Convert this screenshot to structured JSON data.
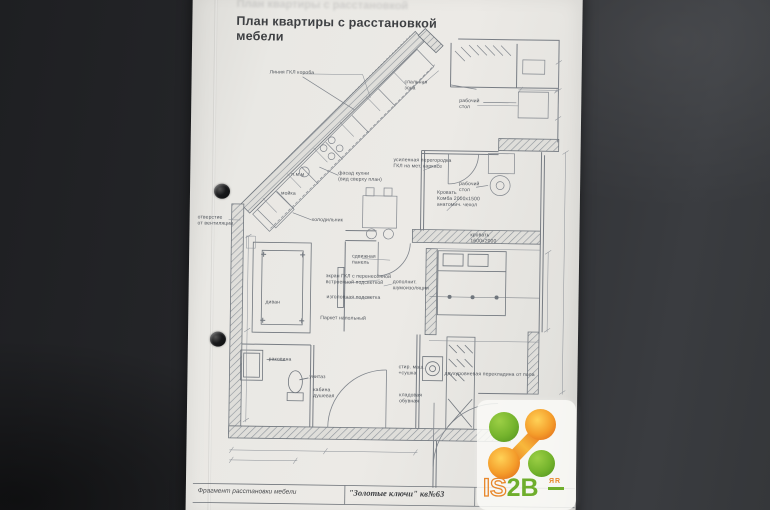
{
  "document": {
    "title": "План квартиры с расстановкой мебели",
    "title_display": "План квартиры с расстановкой\nмебели",
    "ghost_title": "План квартиры с расстановкой",
    "footer": {
      "left": "Фрагмент расстановки мебели",
      "right": "\"Золотые ключи\" кв№63"
    }
  },
  "plan": {
    "labels": [
      {
        "text": "Линия ГКЛ короба",
        "x": 267,
        "y": 72
      },
      {
        "text": "спальная\nзона",
        "x": 402,
        "y": 80
      },
      {
        "text": "рабочий\nстол",
        "x": 457,
        "y": 98
      },
      {
        "text": "усиленная перегородка\nГКЛ на мет. каркасе",
        "x": 392,
        "y": 158
      },
      {
        "text": "рабочий\nстол",
        "x": 458,
        "y": 181
      },
      {
        "text": "Кровать\nКомба 2000х1500\nанатомич. чехол",
        "x": 436,
        "y": 190
      },
      {
        "text": "кровать\n1600х2000",
        "x": 470,
        "y": 232
      },
      {
        "text": "п.м.м",
        "x": 290,
        "y": 174
      },
      {
        "text": "мойка",
        "x": 280,
        "y": 193
      },
      {
        "text": "фасад кухни\n(вид сверху план)",
        "x": 337,
        "y": 172
      },
      {
        "text": "холодильник",
        "x": 311,
        "y": 219
      },
      {
        "text": "отверстие\nот вентиляции",
        "x": 197,
        "y": 218
      },
      {
        "text": "диван",
        "x": 266,
        "y": 302
      },
      {
        "text": "сдвижная\nпанель",
        "x": 352,
        "y": 255
      },
      {
        "text": "экран ГКЛ с перенесённой\nвстроенной подсветкой",
        "x": 326,
        "y": 275
      },
      {
        "text": "изголовная подсветка",
        "x": 327,
        "y": 296
      },
      {
        "text": "дополнит.\nшумоизоляция",
        "x": 393,
        "y": 280
      },
      {
        "text": "Паркет напольный",
        "x": 321,
        "y": 317
      },
      {
        "text": "раковина",
        "x": 270,
        "y": 359
      },
      {
        "text": "унитаз",
        "x": 311,
        "y": 376
      },
      {
        "text": "кабина\nдушевая",
        "x": 315,
        "y": 389
      },
      {
        "text": "стир. маш.\n+сушка",
        "x": 400,
        "y": 365
      },
      {
        "text": "кладовая\nобувная",
        "x": 401,
        "y": 393
      },
      {
        "text": "двухуровневая перекладина от пола",
        "x": 446,
        "y": 371
      }
    ]
  },
  "logo": {
    "is": "IS",
    "tob": "2B",
    "sup": "ЯR",
    "orange": "#e8872a",
    "green": "#6fae2c"
  }
}
